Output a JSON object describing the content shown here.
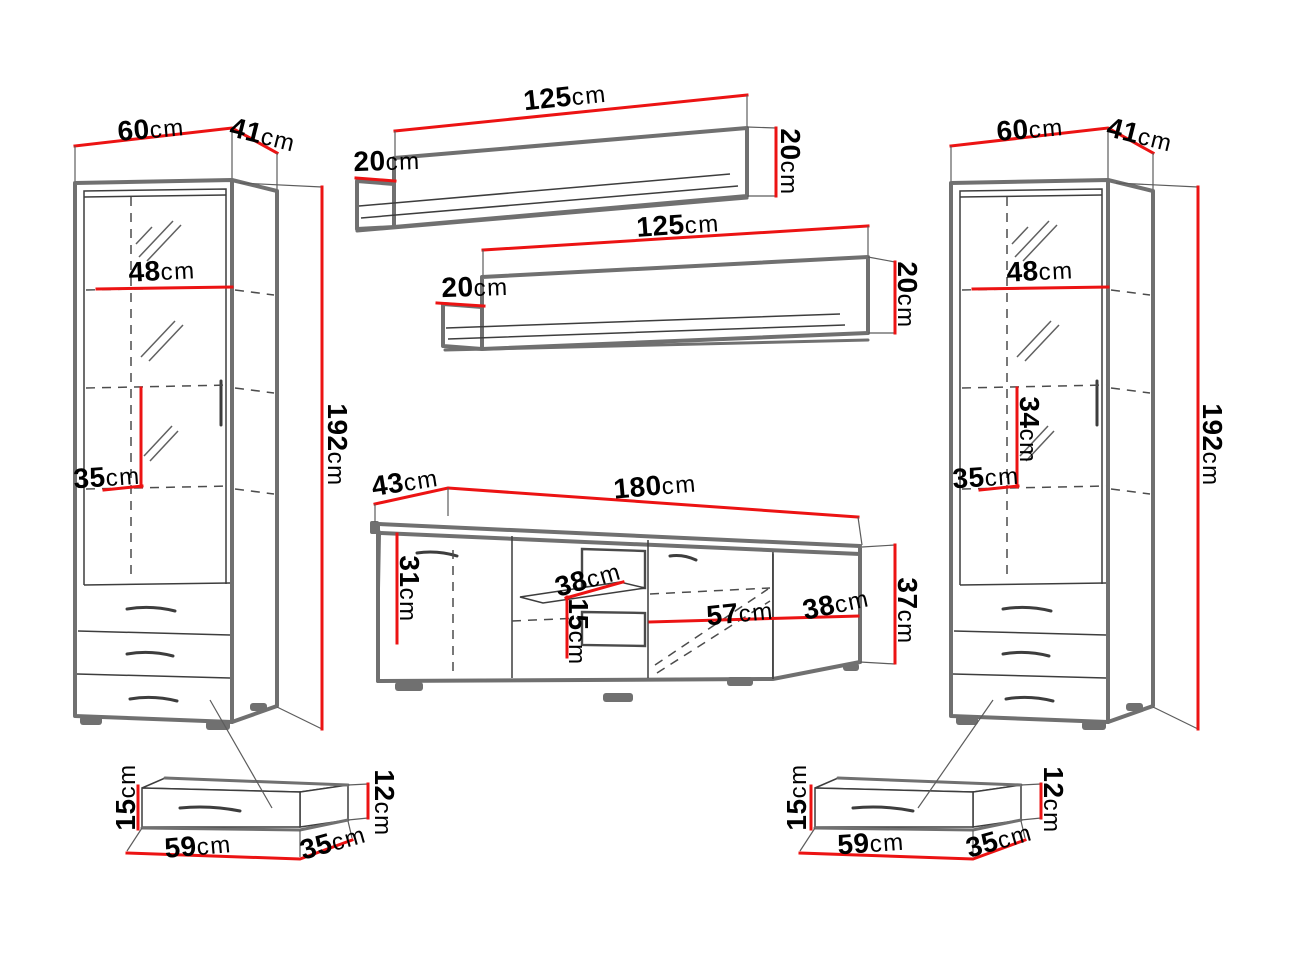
{
  "diagram": "furniture-wall-unit-dimensions",
  "colors": {
    "dimension_line": "#ec1313",
    "sketch_line": "#3d3d3d",
    "edge_line": "#707070",
    "text": "#000000"
  },
  "dims": {
    "lc_width": {
      "v": "60",
      "u": "cm"
    },
    "lc_depth": {
      "v": "41",
      "u": "cm"
    },
    "lc_shelf_width": {
      "v": "48",
      "u": "cm"
    },
    "lc_section_heightـ34": {
      "v": "34",
      "u": "cm"
    },
    "lc_shelf_depth": {
      "v": "35",
      "u": "cm"
    },
    "lc_height": {
      "v": "192",
      "u": "cm"
    },
    "shelf1_width": {
      "v": "125",
      "u": "cm"
    },
    "shelf1_depth": {
      "v": "20",
      "u": "cm"
    },
    "shelf1_height": {
      "v": "20",
      "u": "cm"
    },
    "shelf2_width": {
      "v": "125",
      "u": "cm"
    },
    "shelf2_depth": {
      "v": "20",
      "u": "cm"
    },
    "shelf2_height": {
      "v": "20",
      "u": "cm"
    },
    "tv_depth": {
      "v": "43",
      "u": "cm"
    },
    "tv_width": {
      "v": "180",
      "u": "cm"
    },
    "tv_inner_height": {
      "v": "31",
      "u": "cm"
    },
    "tv_shelf_depth": {
      "v": "38",
      "u": "cm"
    },
    "tv_shelf_gap": {
      "v": "15",
      "u": "cm"
    },
    "tv_compartment_width": {
      "v": "57",
      "u": "cm"
    },
    "tv_side_depth": {
      "v": "38",
      "u": "cm"
    },
    "tv_height": {
      "v": "37",
      "u": "cm"
    },
    "rc_width": {
      "v": "60",
      "u": "cm"
    },
    "rc_depth": {
      "v": "41",
      "u": "cm"
    },
    "rc_shelf_width": {
      "v": "48",
      "u": "cm"
    },
    "rc_section_height_34": {
      "v": "34",
      "u": "cm"
    },
    "rc_shelf_depth": {
      "v": "35",
      "u": "cm"
    },
    "rc_height": {
      "v": "192",
      "u": "cm"
    },
    "drawer1_front_height": {
      "v": "15",
      "u": "cm"
    },
    "drawer1_width": {
      "v": "59",
      "u": "cm"
    },
    "drawer1_depth": {
      "v": "35",
      "u": "cm"
    },
    "drawer1_side_height": {
      "v": "12",
      "u": "cm"
    },
    "drawer2_front_height": {
      "v": "15",
      "u": "cm"
    },
    "drawer2_width": {
      "v": "59",
      "u": "cm"
    },
    "drawer2_depth": {
      "v": "35",
      "u": "cm"
    },
    "drawer2_side_height": {
      "v": "12",
      "u": "cm"
    }
  }
}
